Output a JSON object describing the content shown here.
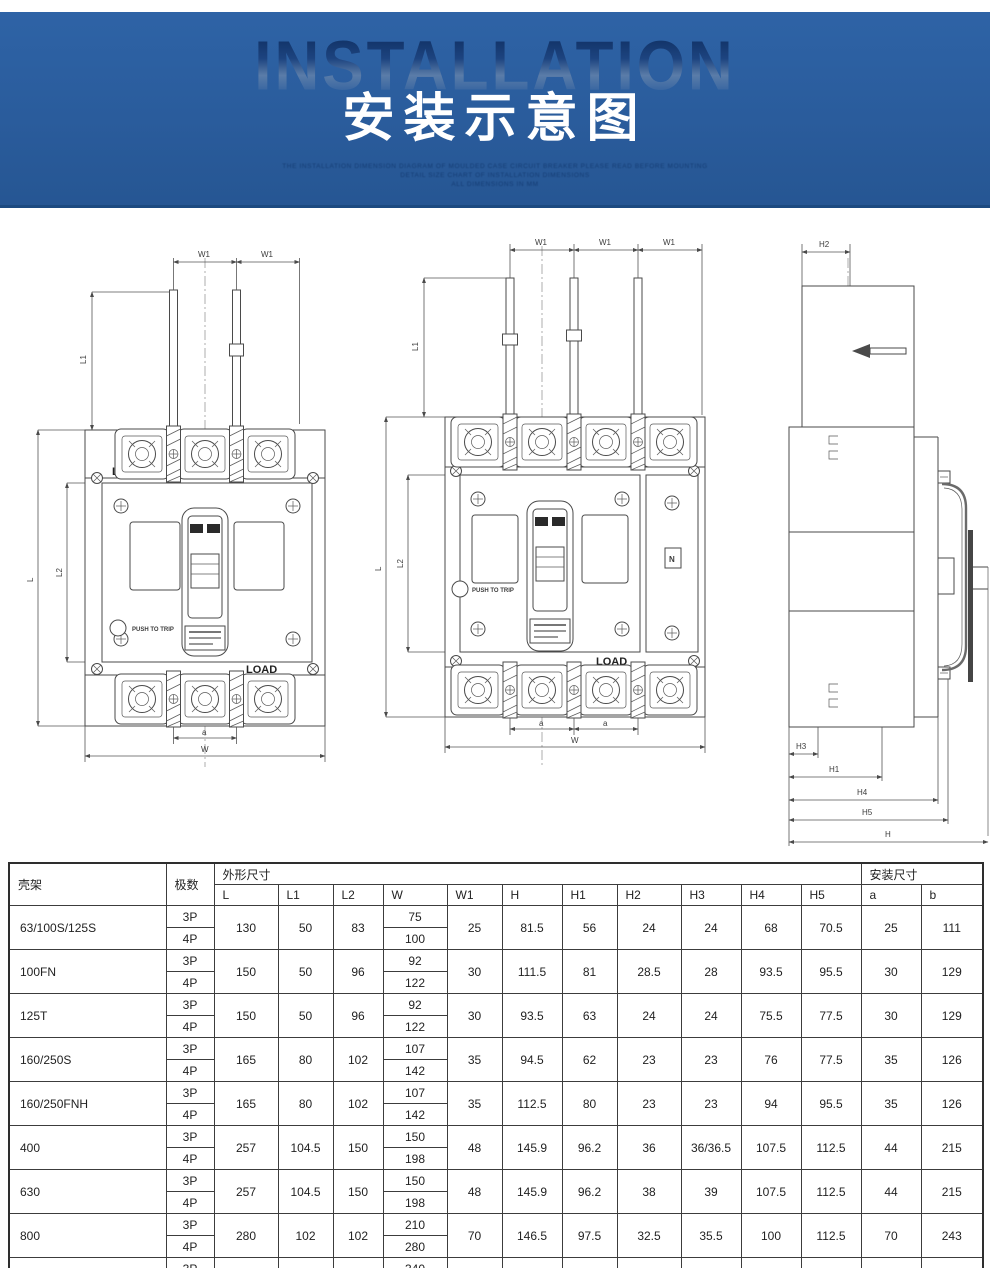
{
  "banner": {
    "watermark": "INSTALLATION",
    "title": "安装示意图",
    "fine_print_lines": [
      "THE INSTALLATION DIMENSION DIAGRAM OF MOULDED CASE CIRCUIT BREAKER PLEASE READ BEFORE MOUNTING",
      "DETAIL SIZE CHART OF INSTALLATION DIMENSIONS",
      "ALL DIMENSIONS IN MM"
    ],
    "colors": {
      "banner_bg": "#2a5c9c",
      "banner_edge": "#1c4a80",
      "title_color": "#ffffff",
      "watermark_top": "#0e2e60"
    }
  },
  "drawings": {
    "labels": {
      "w1": "W1",
      "l": "L",
      "l1": "L1",
      "l2": "L2",
      "a": "a",
      "w": "W",
      "h": "H",
      "h1": "H1",
      "h2": "H2",
      "h3": "H3",
      "h4": "H4",
      "h5": "H5",
      "line": "LINE",
      "load": "LOAD",
      "push_to_trip": "PUSH TO TRIP",
      "n": "N"
    },
    "line_color": "#4a4a4a"
  },
  "table": {
    "header": {
      "frame": "壳架",
      "poles": "极数",
      "outline_group": "外形尺寸",
      "install_group": "安装尺寸",
      "dims": [
        "L",
        "L1",
        "L2",
        "W",
        "W1",
        "H",
        "H1",
        "H2",
        "H3",
        "H4",
        "H5"
      ],
      "install_dims": [
        "a",
        "b"
      ]
    },
    "rows": [
      {
        "frame": "63/100S/125S",
        "poles": [
          "3P",
          "4P"
        ],
        "L": "130",
        "L1": "50",
        "L2": "83",
        "W": [
          "75",
          "100"
        ],
        "W1": "25",
        "H": "81.5",
        "H1": "56",
        "H2": "24",
        "H3": "24",
        "H4": "68",
        "H5": "70.5",
        "a": "25",
        "b": "111"
      },
      {
        "frame": "100FN",
        "poles": [
          "3P",
          "4P"
        ],
        "L": "150",
        "L1": "50",
        "L2": "96",
        "W": [
          "92",
          "122"
        ],
        "W1": "30",
        "H": "111.5",
        "H1": "81",
        "H2": "28.5",
        "H3": "28",
        "H4": "93.5",
        "H5": "95.5",
        "a": "30",
        "b": "129"
      },
      {
        "frame": "125T",
        "poles": [
          "3P",
          "4P"
        ],
        "L": "150",
        "L1": "50",
        "L2": "96",
        "W": [
          "92",
          "122"
        ],
        "W1": "30",
        "H": "93.5",
        "H1": "63",
        "H2": "24",
        "H3": "24",
        "H4": "75.5",
        "H5": "77.5",
        "a": "30",
        "b": "129"
      },
      {
        "frame": "160/250S",
        "poles": [
          "3P",
          "4P"
        ],
        "L": "165",
        "L1": "80",
        "L2": "102",
        "W": [
          "107",
          "142"
        ],
        "W1": "35",
        "H": "94.5",
        "H1": "62",
        "H2": "23",
        "H3": "23",
        "H4": "76",
        "H5": "77.5",
        "a": "35",
        "b": "126"
      },
      {
        "frame": "160/250FNH",
        "poles": [
          "3P",
          "4P"
        ],
        "L": "165",
        "L1": "80",
        "L2": "102",
        "W": [
          "107",
          "142"
        ],
        "W1": "35",
        "H": "112.5",
        "H1": "80",
        "H2": "23",
        "H3": "23",
        "H4": "94",
        "H5": "95.5",
        "a": "35",
        "b": "126"
      },
      {
        "frame": "400",
        "poles": [
          "3P",
          "4P"
        ],
        "L": "257",
        "L1": "104.5",
        "L2": "150",
        "W": [
          "150",
          "198"
        ],
        "W1": "48",
        "H": "145.9",
        "H1": "96.2",
        "H2": "36",
        "H3": "36/36.5",
        "H4": "107.5",
        "H5": "112.5",
        "a": "44",
        "b": "215"
      },
      {
        "frame": "630",
        "poles": [
          "3P",
          "4P"
        ],
        "L": "257",
        "L1": "104.5",
        "L2": "150",
        "W": [
          "150",
          "198"
        ],
        "W1": "48",
        "H": "145.9",
        "H1": "96.2",
        "H2": "38",
        "H3": "39",
        "H4": "107.5",
        "H5": "112.5",
        "a": "44",
        "b": "215"
      },
      {
        "frame": "800",
        "poles": [
          "3P",
          "4P"
        ],
        "L": "280",
        "L1": "102",
        "L2": "102",
        "W": [
          "210",
          "280"
        ],
        "W1": "70",
        "H": "146.5",
        "H1": "97.5",
        "H2": "32.5",
        "H3": "35.5",
        "H4": "100",
        "H5": "112.5",
        "a": "70",
        "b": "243"
      },
      {
        "frame": "1250",
        "poles": [
          "3P",
          "4P"
        ],
        "L": "400",
        "L1": "131",
        "L2": "97.5",
        "W": [
          "340",
          "440"
        ],
        "W1": "70",
        "H": "177.5",
        "H1": "124",
        "H2": "32",
        "H3": "50",
        "H4": "140",
        "H5": "152.5",
        "a": "70",
        "b": "270"
      }
    ]
  }
}
